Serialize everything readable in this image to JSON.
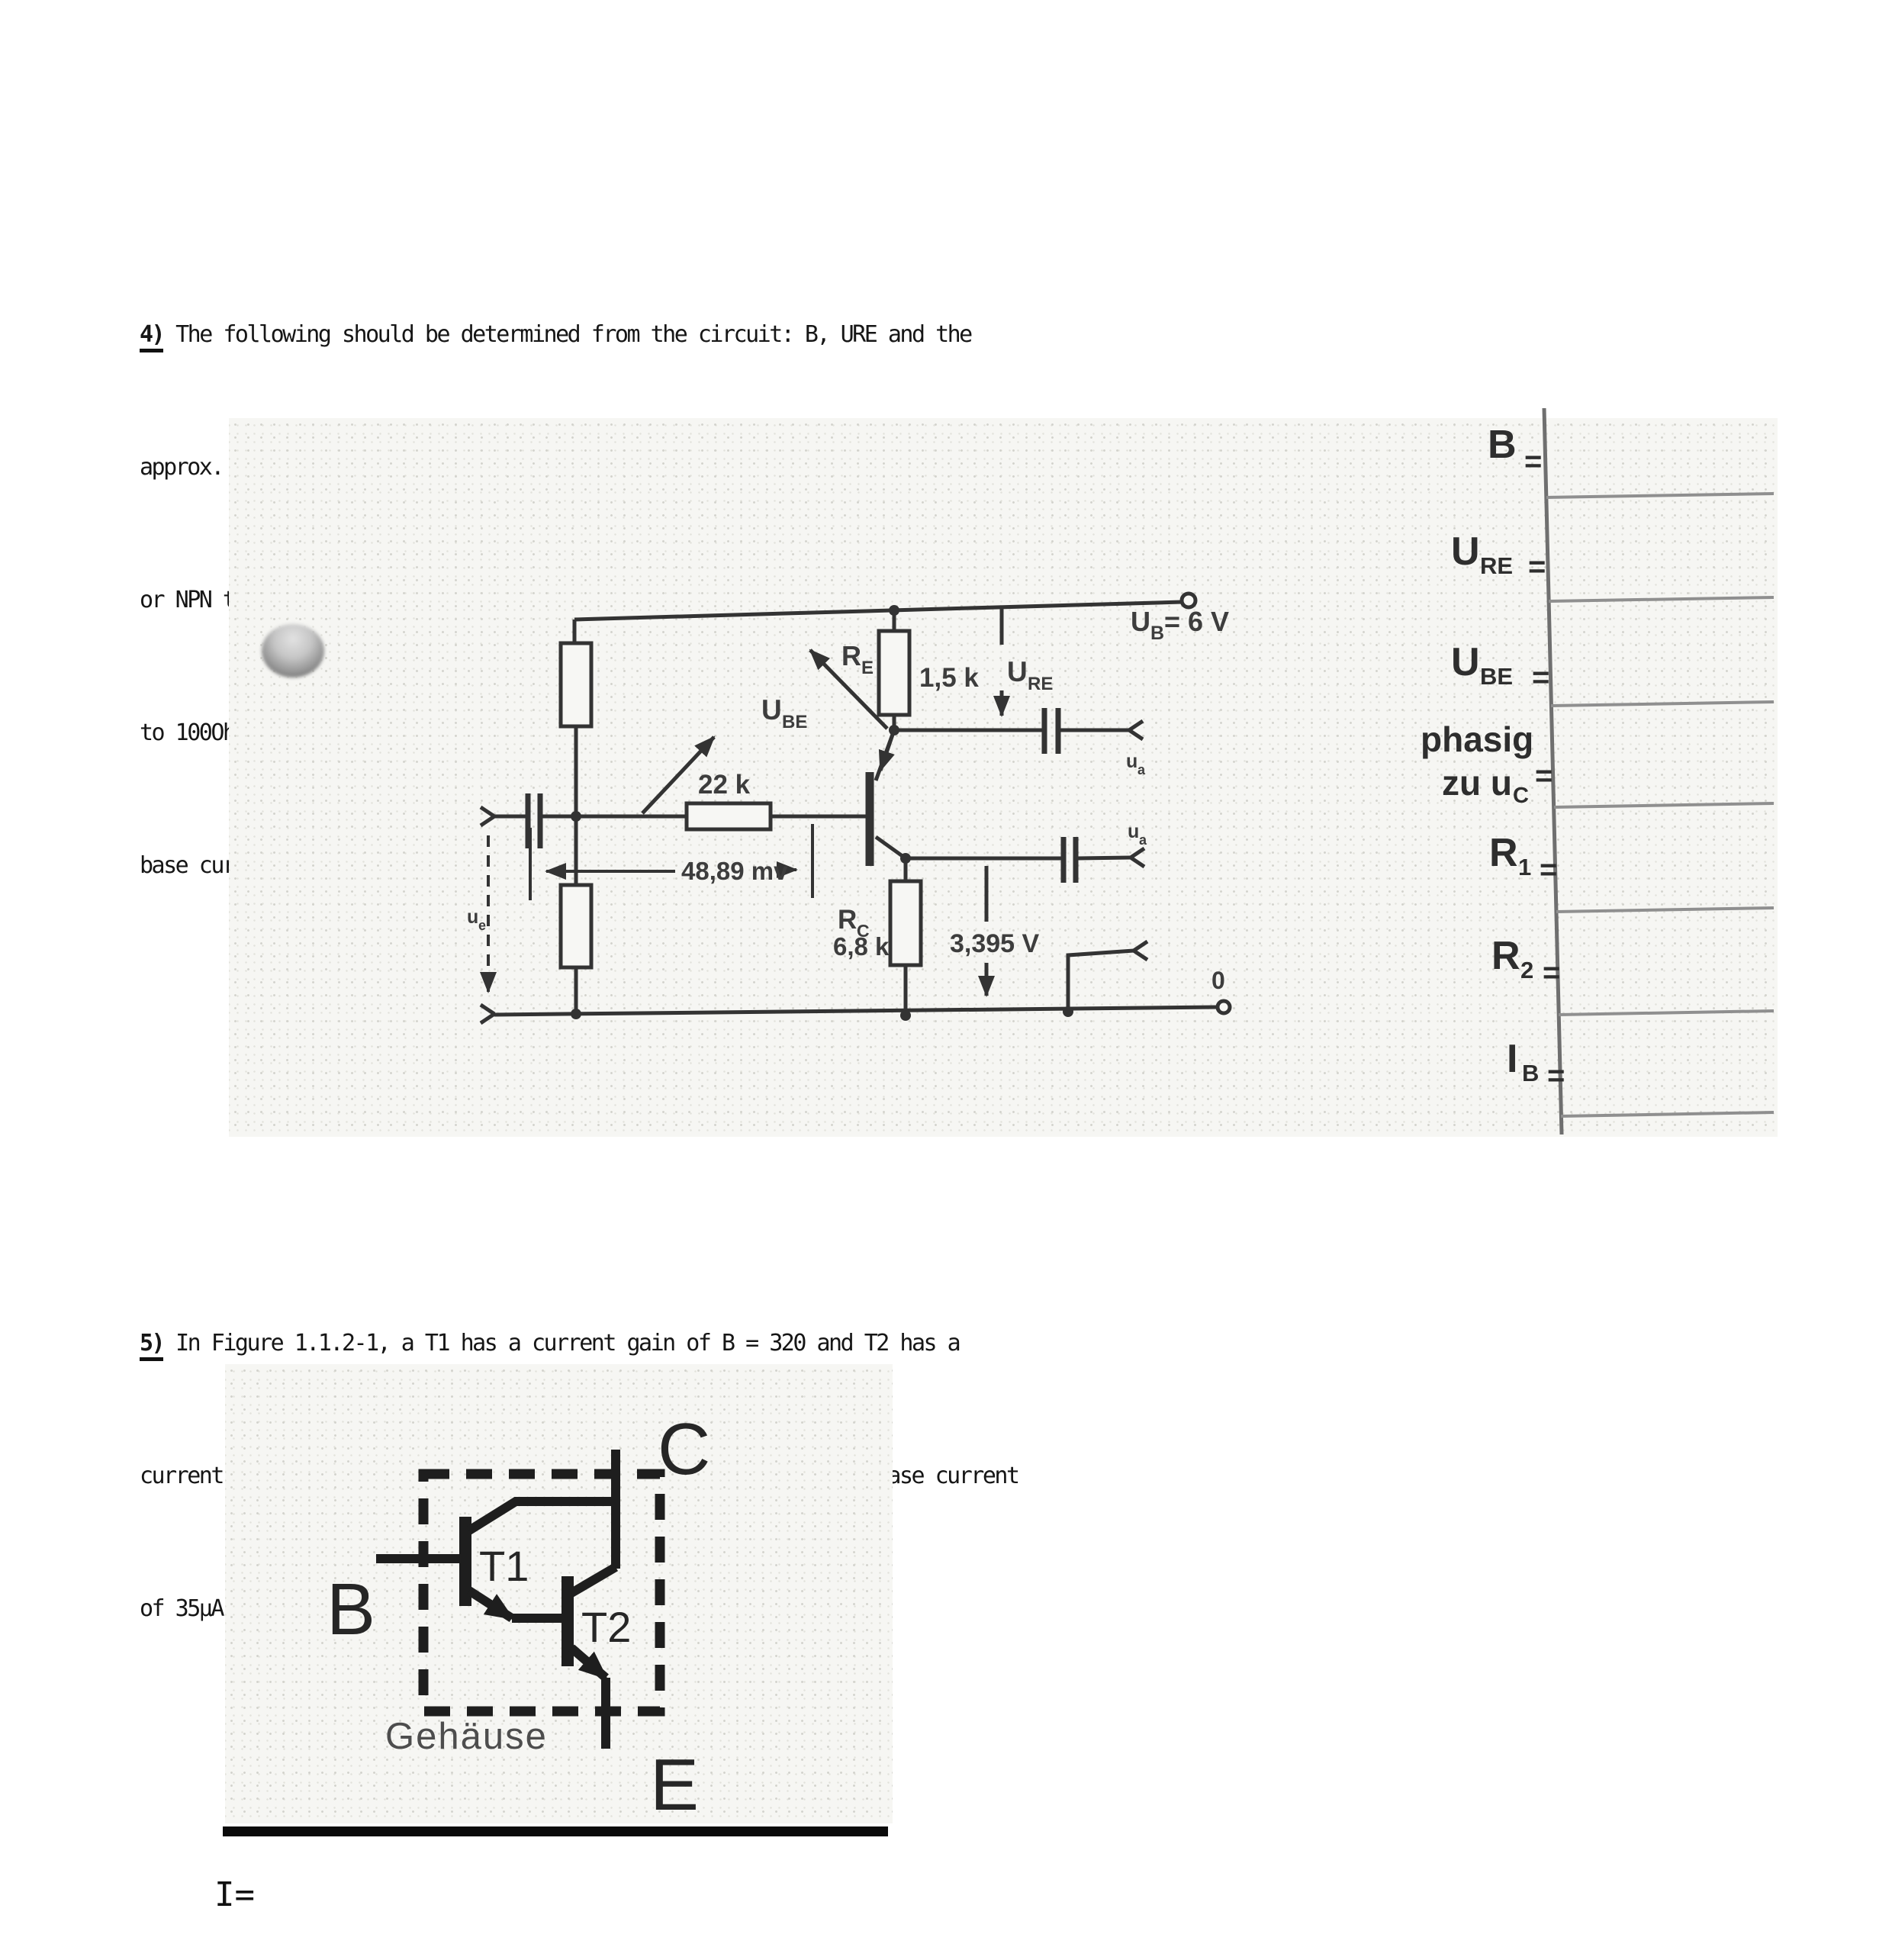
{
  "section4": {
    "number": "4)",
    "lines": [
      "The following should be determined from the circuit: B, URE and the",
      "approx. Value of UBE- Which output signal is in phase with ue? Is it a PNP",
      "or NPN transistor? How large do you choose the values R1 and R2 (values up",
      "to 100Ohm) so that the operating data are set? What is the value of the",
      "base current?"
    ]
  },
  "circuit": {
    "supply": {
      "base": "U",
      "sub": "B",
      "rest": "= 6 V"
    },
    "re": {
      "base": "R",
      "sub": "E",
      "value": "1,5 k"
    },
    "ure": {
      "base": "U",
      "sub": "RE"
    },
    "ube": {
      "base": "U",
      "sub": "BE"
    },
    "r_base": "22 k",
    "mv": "48,89 mv",
    "rc": {
      "base": "R",
      "sub": "C",
      "value": "6,8 k"
    },
    "vc": "3,395 V",
    "zero": "0",
    "ue": {
      "base": "u",
      "sub": "e"
    },
    "ua_top": {
      "base": "u",
      "sub": "a"
    },
    "ua_bottom": {
      "base": "u",
      "sub": "a"
    }
  },
  "answers": {
    "equals": "=",
    "rows": [
      {
        "main": "B",
        "sub": ""
      },
      {
        "main": "U",
        "sub": "RE"
      },
      {
        "main": "U",
        "sub": "BE"
      },
      {
        "line1": "phasig",
        "line2": "zu u",
        "line2_sub": "C"
      },
      {
        "main": "R",
        "sub": "1"
      },
      {
        "main": "R",
        "sub": "2"
      },
      {
        "main": "I",
        "sub": "B"
      }
    ]
  },
  "section5": {
    "number": "5)",
    "lines": [
      "In Figure 1.1.2-1, a T1 has a current gain of B = 320 and T2 has a",
      "current gain of B = 90. What is the output current at T2 if a base current",
      "of 35μA is fed into T1?"
    ]
  },
  "figure5": {
    "c": "C",
    "b": "B",
    "e": "E",
    "t1": "T1",
    "t2": "T2",
    "case_label": "Gehäuse"
  },
  "footer": {
    "current": "I="
  }
}
